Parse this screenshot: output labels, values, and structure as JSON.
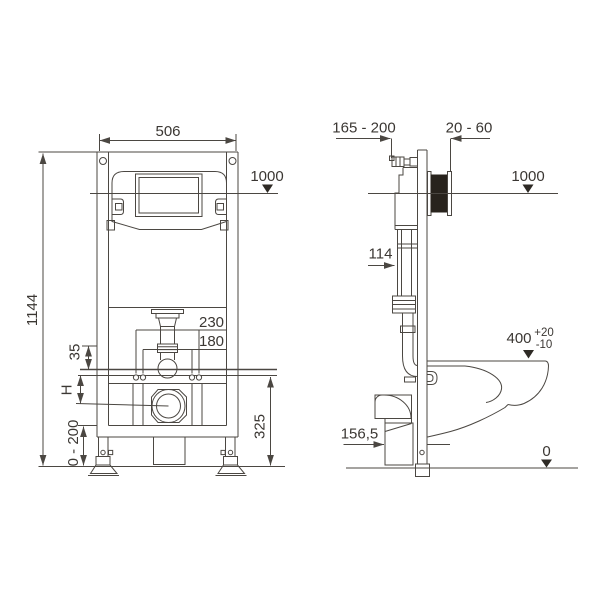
{
  "drawing_title": "wall-hung-wc-installation-frame-dimension-drawing",
  "colors": {
    "line": "#4b4742",
    "text": "#3b3733",
    "black_fill": "#28231d",
    "background": "#ffffff"
  },
  "front_view": {
    "width": "506",
    "level": "1000",
    "height": "1144",
    "anchors_outer": "230",
    "anchors_inner": "180",
    "offset": "35",
    "h": "H",
    "feet_range": "0 - 200",
    "lower_height": "325"
  },
  "side_view": {
    "depth_range": "165 - 200",
    "wall_gap": "20 - 60",
    "level": "1000",
    "cistern_depth": "114",
    "bowl_height": "400",
    "tol_plus": "+20",
    "tol_minus": "-10",
    "outlet_height": "156,5",
    "floor_level": "0"
  }
}
